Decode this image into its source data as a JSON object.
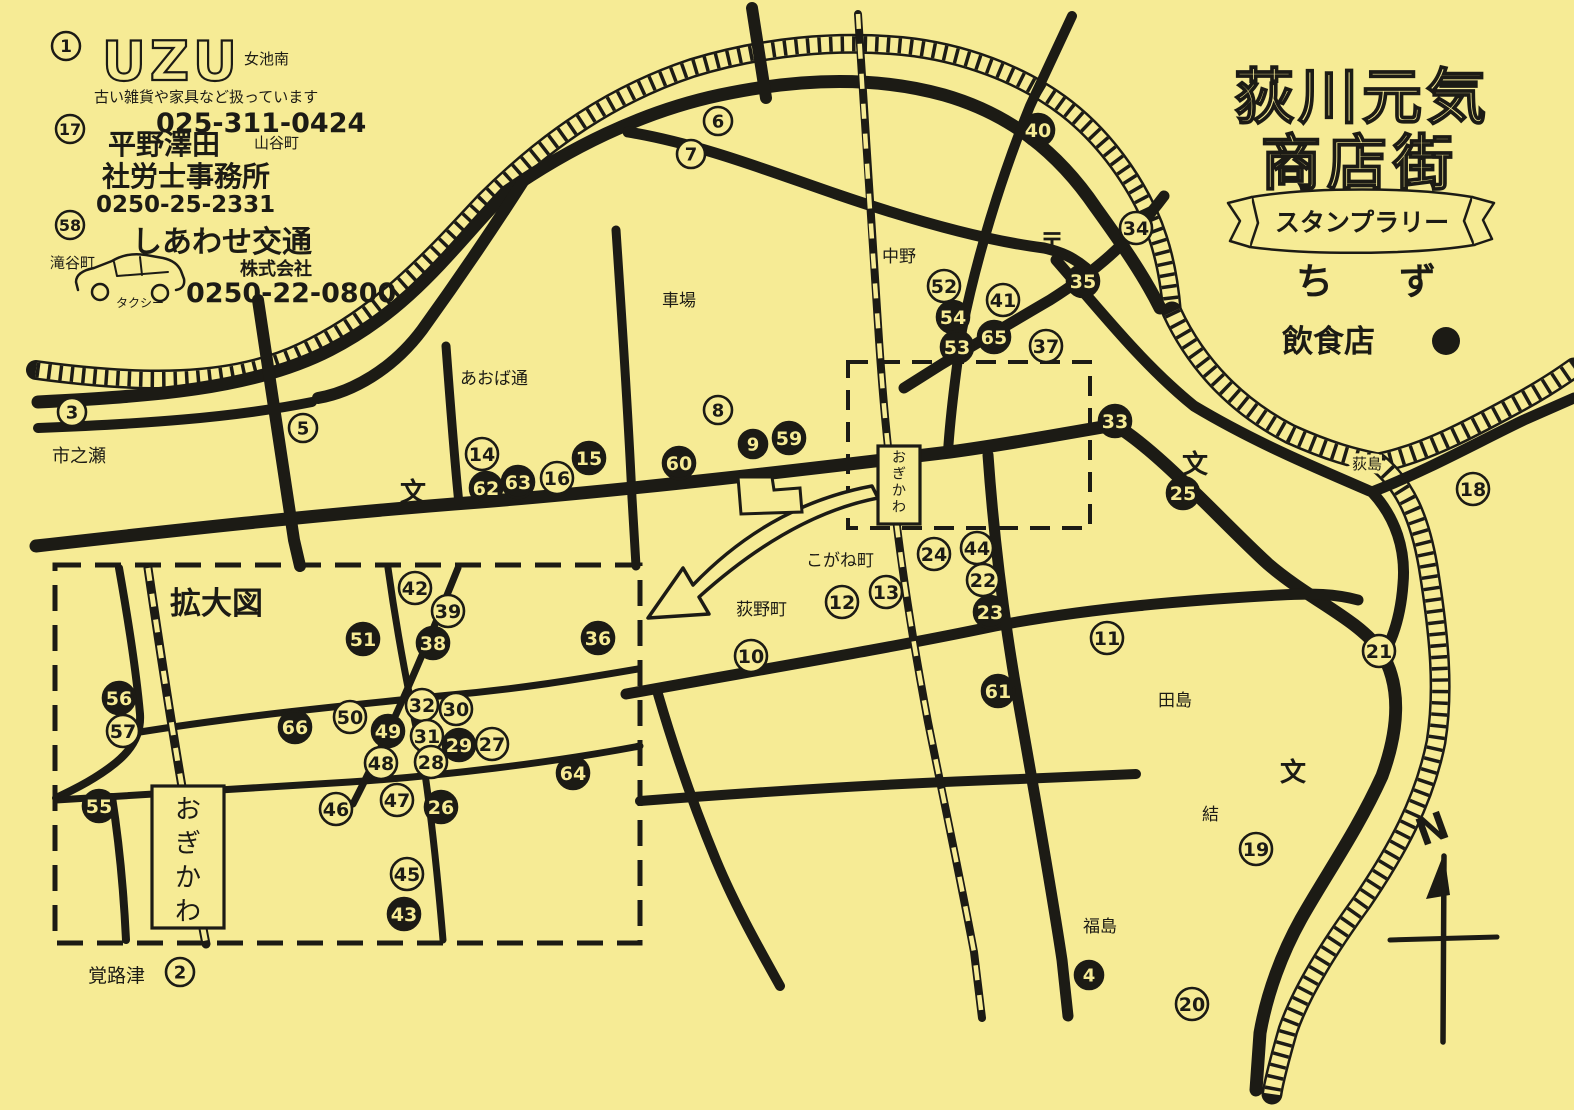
{
  "colors": {
    "paper": "#f6eb95",
    "ink": "#1c1b15"
  },
  "header": {
    "title_line1": "荻川元気",
    "title_line2": "商店街",
    "banner": "スタンプラリー",
    "map_word": "ちず",
    "legend_restaurant_label": "飲食店",
    "legend_restaurant_symbol": "filled-circle"
  },
  "directory": [
    {
      "num": "1",
      "name": "UZU",
      "area": "女池南",
      "desc": "古い雑貨や家具など扱っています",
      "phone": "025-311-0424"
    },
    {
      "num": "17",
      "name": "平野澤田",
      "name2": "社労士事務所",
      "area": "山谷町",
      "phone": "0250-25-2331"
    },
    {
      "num": "58",
      "name": "しあわせ交通",
      "name2": "株式会社",
      "area": "滝谷町",
      "vehicle": "タクシー",
      "phone": "0250-22-0800"
    }
  ],
  "map": {
    "enlarged_box_label": "拡大図",
    "station_name": "おぎかわ",
    "compass_label": "N",
    "markers": [
      {
        "n": "3",
        "x": 72,
        "y": 412,
        "filled": false
      },
      {
        "n": "5",
        "x": 303,
        "y": 428,
        "filled": false
      },
      {
        "n": "6",
        "x": 718,
        "y": 121,
        "filled": false
      },
      {
        "n": "7",
        "x": 691,
        "y": 154,
        "filled": false
      },
      {
        "n": "40",
        "x": 1038,
        "y": 130,
        "filled": true
      },
      {
        "n": "34",
        "x": 1136,
        "y": 228,
        "filled": false
      },
      {
        "n": "35",
        "x": 1083,
        "y": 281,
        "filled": true
      },
      {
        "n": "52",
        "x": 944,
        "y": 286,
        "filled": false
      },
      {
        "n": "54",
        "x": 953,
        "y": 317,
        "filled": true
      },
      {
        "n": "53",
        "x": 957,
        "y": 347,
        "filled": true
      },
      {
        "n": "41",
        "x": 1003,
        "y": 300,
        "filled": false
      },
      {
        "n": "65",
        "x": 994,
        "y": 337,
        "filled": true
      },
      {
        "n": "37",
        "x": 1046,
        "y": 346,
        "filled": false
      },
      {
        "n": "33",
        "x": 1115,
        "y": 421,
        "filled": true
      },
      {
        "n": "25",
        "x": 1183,
        "y": 493,
        "filled": true
      },
      {
        "n": "18",
        "x": 1473,
        "y": 489,
        "filled": false
      },
      {
        "n": "8",
        "x": 718,
        "y": 410,
        "filled": false
      },
      {
        "n": "14",
        "x": 482,
        "y": 454,
        "filled": false
      },
      {
        "n": "62",
        "x": 486,
        "y": 488,
        "filled": true
      },
      {
        "n": "63",
        "x": 518,
        "y": 482,
        "filled": true
      },
      {
        "n": "16",
        "x": 557,
        "y": 478,
        "filled": false
      },
      {
        "n": "15",
        "x": 589,
        "y": 458,
        "filled": true
      },
      {
        "n": "60",
        "x": 679,
        "y": 463,
        "filled": true
      },
      {
        "n": "9",
        "x": 753,
        "y": 444,
        "filled": true
      },
      {
        "n": "59",
        "x": 789,
        "y": 438,
        "filled": true
      },
      {
        "n": "24",
        "x": 934,
        "y": 554,
        "filled": false
      },
      {
        "n": "44",
        "x": 977,
        "y": 548,
        "filled": false
      },
      {
        "n": "22",
        "x": 983,
        "y": 580,
        "filled": false
      },
      {
        "n": "23",
        "x": 990,
        "y": 612,
        "filled": true
      },
      {
        "n": "13",
        "x": 886,
        "y": 592,
        "filled": false
      },
      {
        "n": "12",
        "x": 842,
        "y": 602,
        "filled": false
      },
      {
        "n": "10",
        "x": 751,
        "y": 656,
        "filled": false
      },
      {
        "n": "11",
        "x": 1107,
        "y": 638,
        "filled": false
      },
      {
        "n": "61",
        "x": 998,
        "y": 691,
        "filled": true
      },
      {
        "n": "21",
        "x": 1379,
        "y": 651,
        "filled": false
      },
      {
        "n": "19",
        "x": 1256,
        "y": 849,
        "filled": false
      },
      {
        "n": "4",
        "x": 1089,
        "y": 975,
        "filled": true
      },
      {
        "n": "20",
        "x": 1192,
        "y": 1004,
        "filled": false
      },
      {
        "n": "2",
        "x": 180,
        "y": 972,
        "filled": false
      },
      {
        "n": "42",
        "x": 415,
        "y": 588,
        "filled": false
      },
      {
        "n": "39",
        "x": 448,
        "y": 611,
        "filled": false
      },
      {
        "n": "51",
        "x": 363,
        "y": 639,
        "filled": true
      },
      {
        "n": "38",
        "x": 433,
        "y": 643,
        "filled": true
      },
      {
        "n": "36",
        "x": 598,
        "y": 638,
        "filled": true
      },
      {
        "n": "56",
        "x": 119,
        "y": 698,
        "filled": true
      },
      {
        "n": "57",
        "x": 123,
        "y": 731,
        "filled": false
      },
      {
        "n": "66",
        "x": 295,
        "y": 727,
        "filled": true
      },
      {
        "n": "50",
        "x": 350,
        "y": 717,
        "filled": false
      },
      {
        "n": "49",
        "x": 388,
        "y": 731,
        "filled": true
      },
      {
        "n": "32",
        "x": 422,
        "y": 705,
        "filled": false
      },
      {
        "n": "30",
        "x": 456,
        "y": 709,
        "filled": false
      },
      {
        "n": "31",
        "x": 427,
        "y": 736,
        "filled": false
      },
      {
        "n": "29",
        "x": 459,
        "y": 745,
        "filled": true
      },
      {
        "n": "27",
        "x": 492,
        "y": 744,
        "filled": false
      },
      {
        "n": "48",
        "x": 381,
        "y": 763,
        "filled": false
      },
      {
        "n": "28",
        "x": 431,
        "y": 762,
        "filled": false
      },
      {
        "n": "64",
        "x": 573,
        "y": 773,
        "filled": true
      },
      {
        "n": "46",
        "x": 336,
        "y": 809,
        "filled": false
      },
      {
        "n": "47",
        "x": 397,
        "y": 800,
        "filled": false
      },
      {
        "n": "26",
        "x": 441,
        "y": 807,
        "filled": true
      },
      {
        "n": "55",
        "x": 99,
        "y": 806,
        "filled": true
      },
      {
        "n": "45",
        "x": 407,
        "y": 874,
        "filled": false
      },
      {
        "n": "43",
        "x": 404,
        "y": 914,
        "filled": true
      }
    ],
    "places": [
      {
        "text": "市之瀬",
        "x": 52,
        "y": 462,
        "size": 18
      },
      {
        "text": "あおば通",
        "x": 460,
        "y": 384,
        "size": 17
      },
      {
        "text": "車場",
        "x": 662,
        "y": 306,
        "size": 17
      },
      {
        "text": "中野",
        "x": 882,
        "y": 262,
        "size": 17
      },
      {
        "text": "〒",
        "x": 1040,
        "y": 250,
        "size": 24,
        "bold": true
      },
      {
        "text": "こがね町",
        "x": 806,
        "y": 566,
        "size": 17
      },
      {
        "text": "荻野町",
        "x": 736,
        "y": 615,
        "size": 17
      },
      {
        "text": "田島",
        "x": 1158,
        "y": 706,
        "size": 17
      },
      {
        "text": "結",
        "x": 1202,
        "y": 820,
        "size": 17
      },
      {
        "text": "福島",
        "x": 1083,
        "y": 932,
        "size": 17
      },
      {
        "text": "荻島",
        "x": 1352,
        "y": 469,
        "size": 15,
        "halo": true
      },
      {
        "text": "覚路津",
        "x": 88,
        "y": 982,
        "size": 19
      },
      {
        "text": "拡大図",
        "x": 170,
        "y": 614,
        "size": 31,
        "bold": true
      },
      {
        "text": "文",
        "x": 400,
        "y": 501,
        "size": 26,
        "bold": true
      },
      {
        "text": "文",
        "x": 1182,
        "y": 473,
        "size": 26,
        "bold": true
      },
      {
        "text": "文",
        "x": 1280,
        "y": 781,
        "size": 26,
        "bold": true
      }
    ],
    "stations": [
      {
        "x": 878,
        "y": 446,
        "w": 42,
        "h": 78,
        "font": 14,
        "step": 16.5,
        "pad": 16
      },
      {
        "x": 152,
        "y": 786,
        "w": 72,
        "h": 142,
        "font": 26,
        "step": 34,
        "pad": 32
      }
    ]
  }
}
